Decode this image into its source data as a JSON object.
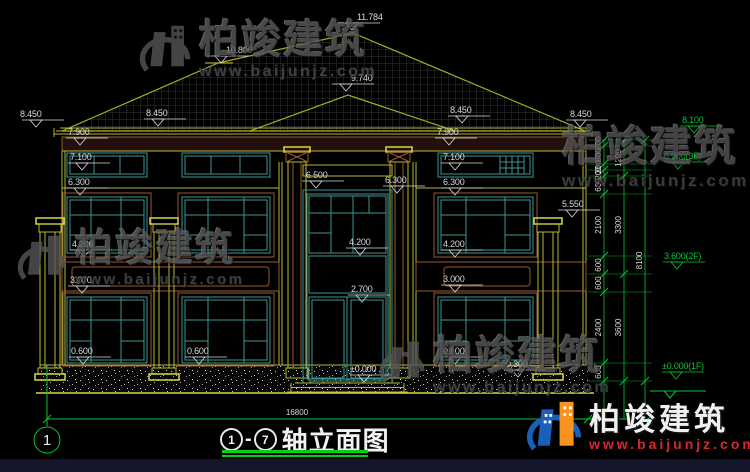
{
  "footer": {
    "axis_start": "1",
    "separator": "-",
    "axis_end": "7",
    "title": "轴立面图",
    "total_dim": "16800",
    "axis_bubble": "1"
  },
  "watermark": {
    "brand": "柏竣建筑",
    "site": "www.baijunjz.com"
  },
  "colors": {
    "dim_green": "#00c832",
    "cad_yellow": "#b8b832",
    "window_teal": "#3d9494",
    "trim_brown": "#9a5a35",
    "watermark_red": "#d42a2a",
    "logo_blue": "#1a5fb8",
    "logo_orange": "#f7931e"
  },
  "levels": [
    {
      "t": "11.784",
      "x": 357,
      "y": 12,
      "ax": 352,
      "c": "w"
    },
    {
      "t": "10.800",
      "x": 226,
      "y": 45,
      "ax": 221,
      "c": "w"
    },
    {
      "t": "9.740",
      "x": 351,
      "y": 73,
      "ax": 346,
      "c": "w"
    },
    {
      "t": "8.450",
      "x": 20,
      "y": 109,
      "ax": 36,
      "c": "w"
    },
    {
      "t": "8.450",
      "x": 146,
      "y": 108,
      "ax": 158,
      "c": "w"
    },
    {
      "t": "8.450",
      "x": 450,
      "y": 105,
      "ax": 462,
      "c": "w"
    },
    {
      "t": "8.450",
      "x": 570,
      "y": 109,
      "ax": 580,
      "c": "w"
    },
    {
      "t": "7.900",
      "x": 68,
      "y": 127,
      "ax": 80,
      "c": "w"
    },
    {
      "t": "7.900",
      "x": 437,
      "y": 127,
      "ax": 449,
      "c": "w"
    },
    {
      "t": "7.100",
      "x": 70,
      "y": 152,
      "ax": 82,
      "c": "w"
    },
    {
      "t": "7.100",
      "x": 443,
      "y": 152,
      "ax": 455,
      "c": "w"
    },
    {
      "t": "6.300",
      "x": 68,
      "y": 177,
      "ax": 80,
      "c": "w"
    },
    {
      "t": "6.300",
      "x": 385,
      "y": 175,
      "ax": 397,
      "c": "w"
    },
    {
      "t": "6.300",
      "x": 443,
      "y": 177,
      "ax": 455,
      "c": "w"
    },
    {
      "t": "6.500",
      "x": 306,
      "y": 170,
      "ax": 316,
      "c": "w"
    },
    {
      "t": "5.550",
      "x": 562,
      "y": 199,
      "ax": 572,
      "c": "w"
    },
    {
      "t": "4.200",
      "x": 72,
      "y": 239,
      "ax": 84,
      "c": "w"
    },
    {
      "t": "4.200",
      "x": 349,
      "y": 237,
      "ax": 360,
      "c": "w"
    },
    {
      "t": "4.200",
      "x": 443,
      "y": 239,
      "ax": 455,
      "c": "w"
    },
    {
      "t": "3.000",
      "x": 70,
      "y": 275,
      "ax": 82,
      "c": "w"
    },
    {
      "t": "3.000",
      "x": 443,
      "y": 274,
      "ax": 455,
      "c": "w"
    },
    {
      "t": "2.700",
      "x": 351,
      "y": 284,
      "ax": 362,
      "c": "w"
    },
    {
      "t": "0.600",
      "x": 71,
      "y": 346,
      "ax": 83,
      "c": "w"
    },
    {
      "t": "0.600",
      "x": 187,
      "y": 346,
      "ax": 199,
      "c": "w"
    },
    {
      "t": "0.600",
      "x": 443,
      "y": 346,
      "ax": 455,
      "c": "w"
    },
    {
      "t": "0.300",
      "x": 506,
      "y": 359,
      "ax": 518,
      "c": "w"
    },
    {
      "t": "±0.000",
      "x": 350,
      "y": 364,
      "ax": 364,
      "c": "w"
    },
    {
      "t": "8.100",
      "x": 682,
      "y": 115,
      "ax": 694,
      "c": "g"
    },
    {
      "t": "6.900(3F)",
      "x": 664,
      "y": 151,
      "ax": 678,
      "c": "g"
    },
    {
      "t": "3.600(2F)",
      "x": 664,
      "y": 251,
      "ax": 677,
      "c": "g"
    },
    {
      "t": "±0.000(1F)",
      "x": 662,
      "y": 361,
      "ax": 676,
      "c": "g"
    }
  ],
  "chains": [
    {
      "x": 604,
      "divs": [
        140,
        146,
        164,
        170,
        176,
        194,
        256,
        274,
        292,
        363,
        381
      ],
      "values": [
        "200",
        "600",
        "200",
        "200",
        "600",
        "2100",
        "600",
        "600",
        "2400",
        "600"
      ]
    },
    {
      "x": 624,
      "divs": [
        140,
        176,
        274,
        381
      ],
      "values": [
        "1200",
        "3300",
        "3600"
      ]
    },
    {
      "x": 645,
      "divs": [
        140,
        381
      ],
      "values": [
        "8100"
      ]
    }
  ]
}
